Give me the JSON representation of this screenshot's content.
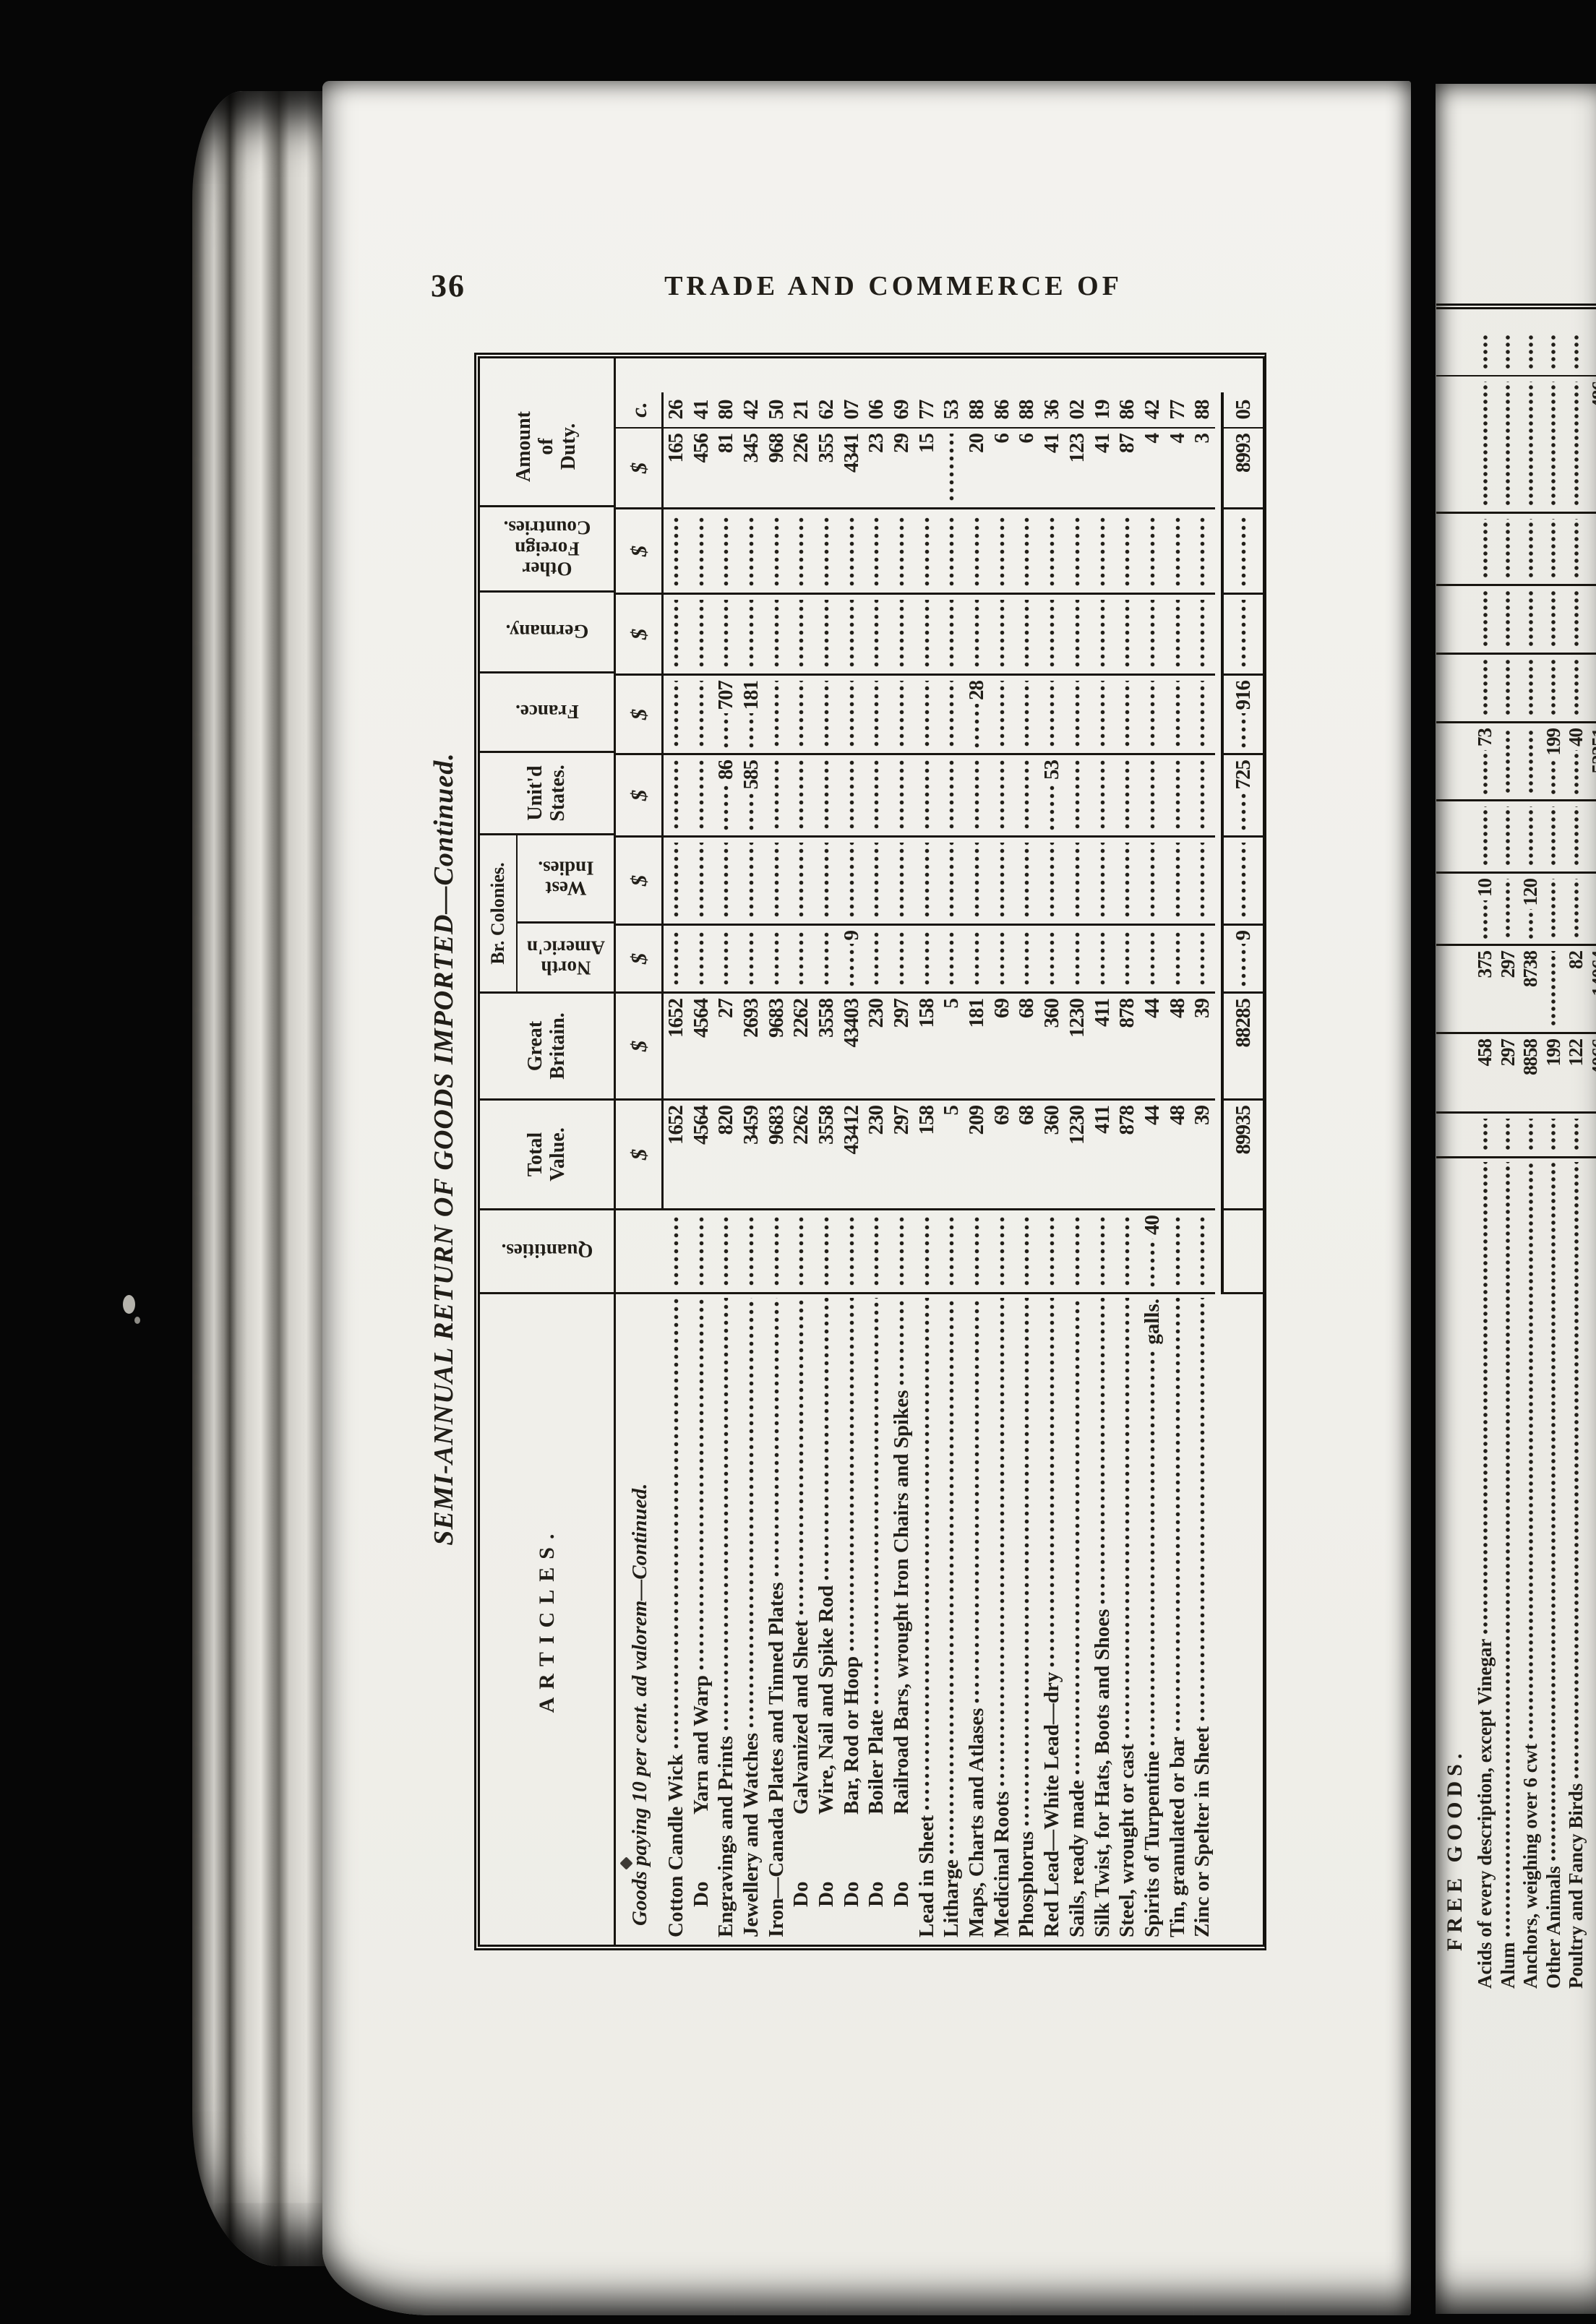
{
  "page": {
    "number": "36",
    "running_title": "TRADE AND COMMERCE OF"
  },
  "table": {
    "title": "SEMI-ANNUAL RETURN OF GOODS IMPORTED—Continued.",
    "section_heading": "Goods paying 10 per cent. ad valorem—Continued.",
    "do_label": "Do",
    "col_headers": {
      "articles": "ARTICLES.",
      "quantities": "Quantities.",
      "total_value": "Total\nValue.",
      "great_britain": "Great\nBritain.",
      "br_colonies": "Br. Colonies.",
      "north_american": "North\nAmeric'n",
      "west_indies": "West\nIndies.",
      "united_states": "Unit'd\nStates.",
      "france": "France.",
      "germany": "Germany.",
      "other_foreign": "Other\nForeign\nCountries.",
      "duty": "Amount\nof\nDuty.",
      "dollar": "$",
      "cents": "c."
    },
    "rows": [
      {
        "name": "Cotton Candle Wick",
        "tv": "1652",
        "gb": "1652",
        "dd": "165",
        "dc": "26"
      },
      {
        "do": true,
        "name": "Yarn and Warp",
        "tv": "4564",
        "gb": "4564",
        "dd": "456",
        "dc": "41"
      },
      {
        "name": "Engravings and Prints",
        "tv": "820",
        "gb": "27",
        "us": "86",
        "fr": "707",
        "dd": "81",
        "dc": "80"
      },
      {
        "name": "Jewellery and Watches",
        "tv": "3459",
        "gb": "2693",
        "us": "585",
        "fr": "181",
        "dd": "345",
        "dc": "42"
      },
      {
        "name": "Iron—Canada Plates and Tinned Plates",
        "tv": "9683",
        "gb": "9683",
        "dd": "968",
        "dc": "50"
      },
      {
        "do": true,
        "name": "Galvanized and Sheet",
        "tv": "2262",
        "gb": "2262",
        "dd": "226",
        "dc": "21"
      },
      {
        "do": true,
        "name": "Wire, Nail and Spike Rod",
        "tv": "3558",
        "gb": "3558",
        "dd": "355",
        "dc": "62"
      },
      {
        "do": true,
        "name": "Bar, Rod or Hoop",
        "tv": "43412",
        "gb": "43403",
        "na": "9",
        "dd": "4341",
        "dc": "07"
      },
      {
        "do": true,
        "name": "Boiler Plate",
        "tv": "230",
        "gb": "230",
        "dd": "23",
        "dc": "06"
      },
      {
        "do": true,
        "name": "Railroad Bars, wrought Iron Chairs and Spikes",
        "tv": "297",
        "gb": "297",
        "dd": "29",
        "dc": "69"
      },
      {
        "name": "Lead in Sheet",
        "tv": "158",
        "gb": "158",
        "dd": "15",
        "dc": "77"
      },
      {
        "name": "Litharge",
        "tv": "5",
        "gb": "5",
        "dc": "53"
      },
      {
        "name": "Maps, Charts and Atlases",
        "tv": "209",
        "gb": "181",
        "fr": "28",
        "dd": "20",
        "dc": "88"
      },
      {
        "name": "Medicinal Roots",
        "tv": "69",
        "gb": "69",
        "dd": "6",
        "dc": "86"
      },
      {
        "name": "Phosphorus",
        "tv": "68",
        "gb": "68",
        "dd": "6",
        "dc": "88"
      },
      {
        "name": "Red Lead—White Lead—dry",
        "tv": "360",
        "gb": "360",
        "us": "53",
        "dd": "41",
        "dc": "36"
      },
      {
        "name": "Sails, ready made",
        "tv": "1230",
        "gb": "1230",
        "dd": "123",
        "dc": "02"
      },
      {
        "name": "Silk Twist, for Hats, Boots and Shoes",
        "tv": "411",
        "gb": "411",
        "dd": "41",
        "dc": "19"
      },
      {
        "name": "Steel, wrought or cast",
        "tv": "878",
        "gb": "878",
        "dd": "87",
        "dc": "86"
      },
      {
        "name": "Spirits of Turpentine",
        "qty_suffix": "galls.",
        "q": "40",
        "tv": "44",
        "gb": "44",
        "dd": "4",
        "dc": "42"
      },
      {
        "name": "Tin, granulated or bar",
        "tv": "48",
        "gb": "48",
        "dd": "4",
        "dc": "77"
      },
      {
        "name": "Zinc or Spelter in Sheet",
        "tv": "39",
        "gb": "39",
        "dd": "3",
        "dc": "88"
      }
    ],
    "totals": {
      "tv": "89935",
      "gb": "88285",
      "na": "9",
      "us": "725",
      "fr": "916",
      "dd": "8993",
      "dc": "05"
    }
  },
  "next_page": {
    "heading": "FREE GOODS.",
    "rows": [
      {
        "name": "Acids of every description, except Vinegar",
        "tv": "458",
        "gb": "375",
        "na": "10",
        "us": "73"
      },
      {
        "name": "Alum",
        "tv": "297",
        "gb": "297"
      },
      {
        "name": "Anchors, weighing over 6 cwt",
        "tv": "8858",
        "gb": "8738",
        "na": "120"
      },
      {
        "name": "Other Animals",
        "tv": "199",
        "us": "199"
      },
      {
        "name": "Poultry and Fancy Birds",
        "tv": "122",
        "gb": "82",
        "us": "40"
      },
      {
        "name": "",
        "tv": "4066",
        "gb": "14064",
        "us": "52351",
        "dd": "486"
      }
    ]
  }
}
